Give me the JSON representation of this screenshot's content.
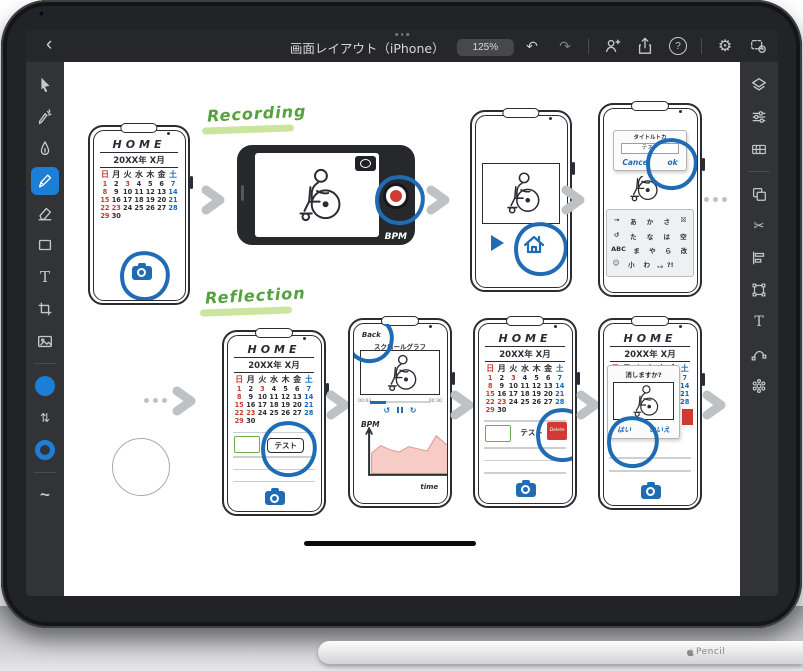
{
  "colors": {
    "accent_blue": "#1b7fd8",
    "annotation_blue": "#1f6cb5",
    "ink": "#2b2b33",
    "red": "#d03a32",
    "calendar_red": "#c63b33",
    "calendar_blue": "#1766b5",
    "green_label": "#55a13e",
    "green_highlight": "#cbe49e",
    "green_input": "#6fae4e",
    "arrow_gray": "#bfc2c4",
    "chart_fill": "#f7cbc6"
  },
  "titlebar": {
    "back_icon": "‹",
    "title": "画面レイアウト（iPhone）",
    "zoom_label": "125%",
    "undo_icon": "↶",
    "redo_icon": "↷",
    "help_label": "?",
    "gear_icon": "⚙"
  },
  "tools": {
    "left": [
      "select",
      "direct-select",
      "pen",
      "pencil",
      "eraser",
      "shape",
      "type",
      "crop",
      "place-image",
      "fill-color",
      "swap-fill-stroke",
      "stroke-color",
      "smoothing"
    ],
    "active": "pencil",
    "right": [
      "layers",
      "properties",
      "grids",
      "combine",
      "scissors",
      "align",
      "transform",
      "type-options",
      "path-tools",
      "repeat"
    ],
    "type_label": "T",
    "swap_icon": "⇅",
    "scissors_icon": "✂",
    "smooth_icon": "~"
  },
  "flows": {
    "recording_label": "Recording",
    "reflection_label": "Reflection"
  },
  "calendar": {
    "title": "HOME",
    "month": "20XX年 X月",
    "weekdays": [
      "日",
      "月",
      "火",
      "水",
      "木",
      "金",
      "土"
    ],
    "weeks": [
      [
        "1",
        "2",
        "3",
        "4",
        "5",
        "6",
        "7"
      ],
      [
        "8",
        "9",
        "10",
        "11",
        "12",
        "13",
        "14"
      ],
      [
        "15",
        "16",
        "17",
        "18",
        "19",
        "20",
        "21"
      ],
      [
        "22",
        "23",
        "24",
        "25",
        "26",
        "27",
        "28"
      ],
      [
        "29",
        "30",
        "",
        "",
        "",
        "",
        ""
      ]
    ],
    "red_dates": [
      "1",
      "3",
      "8",
      "15",
      "22",
      "23",
      "29"
    ],
    "blue_dates": [
      "7",
      "14",
      "21",
      "28"
    ]
  },
  "camera_screen": {
    "bpm_label": "BPM"
  },
  "title_dialog": {
    "label": "タイトルトカ",
    "field_value": "テスト",
    "cancel_label": "Cancel",
    "ok_label": "ok"
  },
  "keyboard": {
    "rows": [
      [
        "→",
        "あ",
        "か",
        "さ",
        "☒"
      ],
      [
        "↺",
        "た",
        "な",
        "は",
        "空"
      ],
      [
        "ABC",
        "ま",
        "や",
        "ら",
        "改"
      ],
      [
        "☺",
        "小",
        "わ",
        "、。?!",
        ""
      ]
    ]
  },
  "list": {
    "entry_label": "テスト",
    "delete_label": "Delete"
  },
  "playback": {
    "back_label": "Back",
    "title": "スクロールグラフ",
    "time_current": "00:03",
    "time_total": "00:30",
    "ylabel": "BPM",
    "xlabel": "time"
  },
  "confirm": {
    "message": "消しますか?",
    "yes_label": "はい",
    "no_label": "いいえ"
  },
  "bpm_chart": {
    "type": "area",
    "values": [
      38,
      52,
      44,
      40,
      50,
      46,
      42,
      70,
      55,
      46
    ],
    "xlabel": "time",
    "ylabel": "BPM"
  },
  "pencil": {
    "label": "Pencil"
  }
}
